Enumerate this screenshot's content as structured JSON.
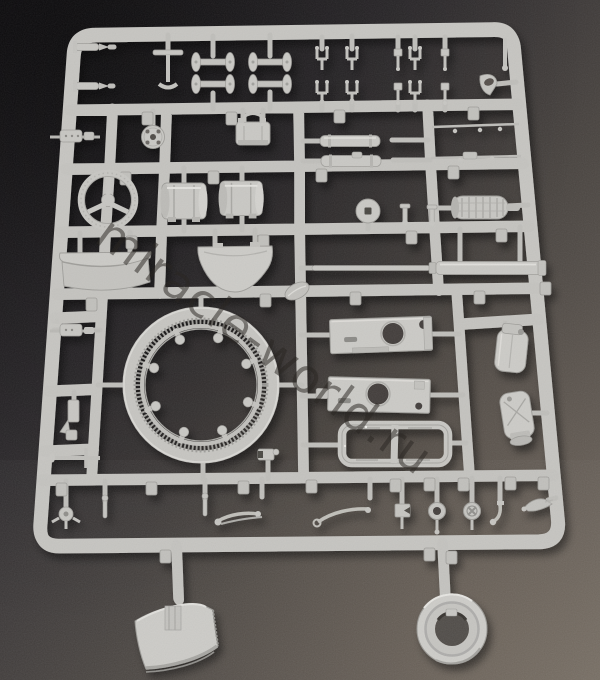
{
  "scene": {
    "type": "photograph",
    "description": "Light grey injection-moulded plastic model kit sprue (parts tree) lying on a dark speckled desk, photographed at a slight angle",
    "watermark": "miracle-world.ru"
  },
  "palette": {
    "sprue_base": "#c7c6c2",
    "sprue_light": "#dcdbd7",
    "sprue_dark": "#9e9d99",
    "desk_top_left": "#121014",
    "desk_mid": "#46423f",
    "desk_bottom_right": "#716a62",
    "watermark_color": "#2a2623",
    "hole_dark": "#423e3b"
  },
  "parts": [
    "turret ring with inner gear teeth and eight knobs",
    "upper hull plate with round hatch hole",
    "second hull plate with round hole",
    "rectangular hull frame with crossbar",
    "long gun barrel with stepped sleeve",
    "two ribbed engine drums",
    "Y-spoke steering wheel",
    "ribbed exhaust muffler",
    "two stowage canisters",
    "two curved fender plates",
    "twin recuperator cylinders",
    "four wheel axles with road wheels",
    "fork brackets and clevis pins",
    "perforated disc and washer",
    "machine-gun body",
    "suitcase stowage box",
    "linkage rods with ball joints",
    "small hand wheels and cross valve wheel",
    "curved mudguard blade hanging below frame",
    "road-wheel ring hanging below frame",
    "molded number tags on runners"
  ]
}
